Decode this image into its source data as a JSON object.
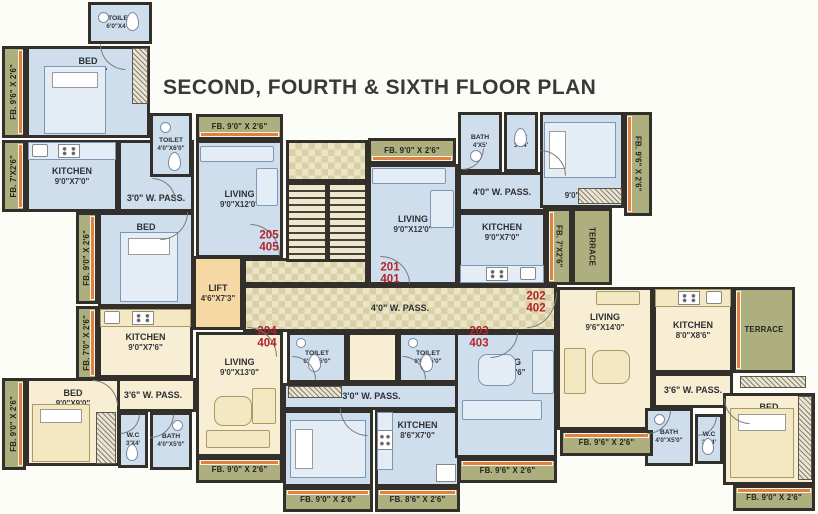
{
  "title": "SECOND, FOURTH & SIXTH FLOOR PLAN",
  "colors": {
    "wall": "#332f2a",
    "room_blue": "#cfdeed",
    "room_cream": "#f8eed4",
    "strip_olive": "#adaf7e",
    "lift_peach": "#f6d8a4",
    "corridor_light": "#ece4c6",
    "corridor_dark": "#d9d0a6",
    "unit_number_red": "#b2252b",
    "window_orange": "#e0813e",
    "title_color": "#39393b"
  },
  "title_pos": {
    "x": 163,
    "y": 76
  },
  "units": [
    {
      "lines": [
        "205",
        "405"
      ],
      "cx": 269,
      "cy": 242
    },
    {
      "lines": [
        "201",
        "401"
      ],
      "cx": 390,
      "cy": 274
    },
    {
      "lines": [
        "202",
        "402"
      ],
      "cx": 536,
      "cy": 303
    },
    {
      "lines": [
        "203",
        "403"
      ],
      "cx": 479,
      "cy": 338
    },
    {
      "lines": [
        "204",
        "404"
      ],
      "cx": 267,
      "cy": 338
    }
  ],
  "rooms": [
    {
      "label": "TOILET",
      "dims": "6'0\"X4'0\"",
      "x": 88,
      "y": 2,
      "w": 64,
      "h": 42,
      "fill": "blue",
      "small": true
    },
    {
      "label": "FB. 9'6\" X 2'6\"",
      "x": 2,
      "y": 46,
      "w": 24,
      "h": 92,
      "fill": "olive",
      "vert": "up",
      "edge": "right"
    },
    {
      "label": "BED",
      "dims": "12'6\"X9'6\"",
      "x": 26,
      "y": 46,
      "w": 124,
      "h": 92,
      "fill": "blue",
      "align": "top"
    },
    {
      "label": "FB. 7'X2'6\"",
      "x": 2,
      "y": 140,
      "w": 24,
      "h": 72,
      "fill": "olive",
      "vert": "up",
      "edge": "right"
    },
    {
      "label": "KITCHEN",
      "dims": "9'0\"X7'0\"",
      "x": 26,
      "y": 140,
      "w": 92,
      "h": 72,
      "fill": "blue"
    },
    {
      "label": "3'0\" W. PASS.",
      "x": 118,
      "y": 140,
      "w": 76,
      "h": 72,
      "fill": "blue",
      "align": "bottom"
    },
    {
      "label": "TOILET",
      "dims": "4'0\"X6'0\"",
      "x": 150,
      "y": 113,
      "w": 42,
      "h": 64,
      "fill": "blue",
      "small": true
    },
    {
      "label": "FB. 9'0\" X 2'6\"",
      "x": 196,
      "y": 114,
      "w": 87,
      "h": 26,
      "fill": "olive",
      "edge": "bottom"
    },
    {
      "label": "LIVING",
      "dims": "9'0\"X12'0\"",
      "x": 196,
      "y": 140,
      "w": 87,
      "h": 118,
      "fill": "blue"
    },
    {
      "label": "BED",
      "dims": "9'0\"X9'0\"",
      "x": 98,
      "y": 212,
      "w": 96,
      "h": 95,
      "fill": "blue",
      "align": "top"
    },
    {
      "label": "FB. 9'0\" X 2'6\"",
      "x": 76,
      "y": 212,
      "w": 22,
      "h": 92,
      "fill": "olive",
      "vert": "up",
      "edge": "right"
    },
    {
      "label": "FB. 7'0\" X 2'6\"",
      "x": 76,
      "y": 306,
      "w": 22,
      "h": 74,
      "fill": "olive",
      "vert": "up",
      "edge": "right"
    },
    {
      "label": "LIFT",
      "dims": "4'6\"X7'3\"",
      "x": 193,
      "y": 256,
      "w": 50,
      "h": 74,
      "fill": "peach"
    },
    {
      "label": "KITCHEN",
      "dims": "9'0\"X7'6\"",
      "x": 98,
      "y": 307,
      "w": 95,
      "h": 71,
      "fill": "cream"
    },
    {
      "label": "LIVING",
      "dims": "9'0\"X13'0\"",
      "x": 196,
      "y": 332,
      "w": 87,
      "h": 125,
      "fill": "cream",
      "align": "top2"
    },
    {
      "label": "3'6\" W. PASS.",
      "x": 110,
      "y": 378,
      "w": 86,
      "h": 34,
      "fill": "cream"
    },
    {
      "label": "BED",
      "dims": "9'0\"X9'0\"",
      "x": 26,
      "y": 378,
      "w": 94,
      "h": 88,
      "fill": "cream",
      "align": "top"
    },
    {
      "label": "FB. 9'0\" X 2'6\"",
      "x": 2,
      "y": 378,
      "w": 24,
      "h": 92,
      "fill": "olive",
      "vert": "up",
      "edge": "right"
    },
    {
      "label": "W.C",
      "dims": "3'X4'",
      "x": 118,
      "y": 412,
      "w": 30,
      "h": 56,
      "fill": "blue",
      "small": true
    },
    {
      "label": "BATH",
      "dims": "4'0\"X5'0\"",
      "x": 150,
      "y": 412,
      "w": 42,
      "h": 58,
      "fill": "blue",
      "small": true
    },
    {
      "label": "FB. 9'0\" X 2'6\"",
      "x": 196,
      "y": 457,
      "w": 87,
      "h": 26,
      "fill": "olive",
      "edge": "top"
    },
    {
      "label": "TOILET",
      "dims": "6'0\"X5'0\"",
      "x": 287,
      "y": 332,
      "w": 60,
      "h": 51,
      "fill": "blue",
      "small": true
    },
    {
      "label": "",
      "x": 347,
      "y": 332,
      "w": 51,
      "h": 51,
      "fill": "cream"
    },
    {
      "label": "TOILET",
      "dims": "6'0\"X5'0\"",
      "x": 398,
      "y": 332,
      "w": 60,
      "h": 51,
      "fill": "blue",
      "small": true
    },
    {
      "label": "3'0\" W. PASS.",
      "x": 283,
      "y": 383,
      "w": 177,
      "h": 27,
      "fill": "blue",
      "align": "bottom"
    },
    {
      "label": "BED",
      "dims": "9'0\"X10'6\"",
      "x": 283,
      "y": 410,
      "w": 90,
      "h": 77,
      "fill": "blue",
      "align": "split"
    },
    {
      "label": "KITCHEN",
      "dims": "8'6\"X7'0\"",
      "x": 375,
      "y": 410,
      "w": 85,
      "h": 77,
      "fill": "blue",
      "align": "top"
    },
    {
      "label": "FB. 9'0\" X 2'6\"",
      "x": 283,
      "y": 487,
      "w": 90,
      "h": 25,
      "fill": "olive",
      "edge": "top"
    },
    {
      "label": "FB. 8'6\" X 2'6\"",
      "x": 375,
      "y": 487,
      "w": 85,
      "h": 25,
      "fill": "olive",
      "edge": "top"
    },
    {
      "label": "LIVING",
      "dims": "9'6\"X12'6\"",
      "x": 455,
      "y": 332,
      "w": 102,
      "h": 126,
      "fill": "blue",
      "align": "top2"
    },
    {
      "label": "FB. 9'6\" X 2'6\"",
      "x": 458,
      "y": 458,
      "w": 99,
      "h": 25,
      "fill": "olive",
      "edge": "top"
    },
    {
      "label": "FB. 9'0\" X 2'6\"",
      "x": 368,
      "y": 138,
      "w": 88,
      "h": 26,
      "fill": "olive",
      "edge": "bottom"
    },
    {
      "label": "LIVING",
      "dims": "9'0\"X12'0\"",
      "x": 368,
      "y": 164,
      "w": 90,
      "h": 121,
      "fill": "blue"
    },
    {
      "label": "BATH",
      "dims": "4'X5'",
      "x": 458,
      "y": 112,
      "w": 44,
      "h": 60,
      "fill": "blue",
      "small": true
    },
    {
      "label": "W.C",
      "dims": "3'X4'",
      "x": 504,
      "y": 112,
      "w": 34,
      "h": 60,
      "fill": "blue",
      "small": true
    },
    {
      "label": "4'0\" W. PASS.",
      "x": 458,
      "y": 172,
      "w": 88,
      "h": 40,
      "fill": "blue"
    },
    {
      "label": "KITCHEN",
      "dims": "9'0\"X7'0\"",
      "x": 458,
      "y": 212,
      "w": 88,
      "h": 73,
      "fill": "blue",
      "align": "top"
    },
    {
      "label": "BED",
      "dims": "9'0\"X9'6\"",
      "x": 540,
      "y": 112,
      "w": 84,
      "h": 96,
      "fill": "blue",
      "align": "split"
    },
    {
      "label": "FB. 9'6\" X 2'6\"",
      "x": 624,
      "y": 112,
      "w": 28,
      "h": 104,
      "fill": "olive",
      "vert": "down",
      "edge": "left"
    },
    {
      "label": "FB. 7'X2'6\"",
      "x": 546,
      "y": 208,
      "w": 26,
      "h": 77,
      "fill": "olive",
      "vert": "down",
      "edge": "left"
    },
    {
      "label": "TERRACE",
      "x": 572,
      "y": 208,
      "w": 40,
      "h": 77,
      "fill": "olive",
      "vert": "down"
    },
    {
      "label": "LIVING",
      "dims": "9'6\"X14'0\"",
      "x": 557,
      "y": 287,
      "w": 96,
      "h": 143,
      "fill": "cream",
      "align": "top2"
    },
    {
      "label": "KITCHEN",
      "dims": "8'0\"X8'6\"",
      "x": 653,
      "y": 287,
      "w": 80,
      "h": 86,
      "fill": "cream"
    },
    {
      "label": "TERRACE",
      "x": 733,
      "y": 287,
      "w": 62,
      "h": 86,
      "fill": "olive",
      "edge": "left"
    },
    {
      "label": "3'6\" W. PASS.",
      "x": 653,
      "y": 373,
      "w": 80,
      "h": 35,
      "fill": "cream"
    },
    {
      "label": "BATH",
      "dims": "4'0\"X5'0\"",
      "x": 645,
      "y": 408,
      "w": 48,
      "h": 58,
      "fill": "blue",
      "small": true
    },
    {
      "label": "W.C",
      "dims": "3'X4'",
      "x": 695,
      "y": 414,
      "w": 28,
      "h": 50,
      "fill": "blue",
      "small": true
    },
    {
      "label": "BED",
      "dims": "9'0\"X11'6\"",
      "x": 723,
      "y": 393,
      "w": 92,
      "h": 92,
      "fill": "cream",
      "align": "split"
    },
    {
      "label": "FB. 9'0\" X 2'6\"",
      "x": 733,
      "y": 485,
      "w": 82,
      "h": 26,
      "fill": "olive",
      "edge": "top"
    },
    {
      "label": "FB. 9'6\" X 2'6\"",
      "x": 560,
      "y": 430,
      "w": 93,
      "h": 26,
      "fill": "olive",
      "edge": "top"
    },
    {
      "label": "4'0\" W. PASS.",
      "x": 243,
      "y": 285,
      "w": 314,
      "h": 47,
      "fill": "checker"
    },
    {
      "label": "",
      "x": 243,
      "y": 258,
      "w": 125,
      "h": 27,
      "fill": "checker"
    },
    {
      "label": "",
      "x": 286,
      "y": 140,
      "w": 82,
      "h": 42,
      "fill": "checker"
    },
    {
      "label": "",
      "x": 286,
      "y": 182,
      "w": 82,
      "h": 80,
      "fill": "stairs"
    }
  ],
  "furniture": [
    {
      "type": "bed",
      "x": 44,
      "y": 66,
      "w": 62,
      "h": 68,
      "tone": "b",
      "pillow": "top"
    },
    {
      "type": "bed",
      "x": 120,
      "y": 232,
      "w": 58,
      "h": 70,
      "tone": "b",
      "pillow": "top"
    },
    {
      "type": "bed",
      "x": 544,
      "y": 122,
      "w": 72,
      "h": 56,
      "tone": "b",
      "pillow": "left"
    },
    {
      "type": "bed",
      "x": 730,
      "y": 408,
      "w": 64,
      "h": 70,
      "tone": "c",
      "pillow": "top"
    },
    {
      "type": "bed",
      "x": 290,
      "y": 420,
      "w": 76,
      "h": 58,
      "tone": "b",
      "pillow": "left"
    },
    {
      "type": "bed",
      "x": 32,
      "y": 404,
      "w": 58,
      "h": 58,
      "tone": "c",
      "pillow": "top"
    },
    {
      "type": "sofa",
      "x": 200,
      "y": 146,
      "w": 74,
      "h": 16,
      "tone": "b"
    },
    {
      "type": "sofa",
      "x": 256,
      "y": 168,
      "w": 22,
      "h": 38,
      "tone": "b"
    },
    {
      "type": "sofa",
      "x": 372,
      "y": 168,
      "w": 74,
      "h": 16,
      "tone": "b"
    },
    {
      "type": "sofa",
      "x": 430,
      "y": 190,
      "w": 24,
      "h": 38,
      "tone": "b"
    },
    {
      "type": "sofa",
      "x": 462,
      "y": 400,
      "w": 80,
      "h": 20,
      "tone": "b"
    },
    {
      "type": "sofa",
      "x": 532,
      "y": 350,
      "w": 22,
      "h": 44,
      "tone": "b"
    },
    {
      "type": "table",
      "x": 478,
      "y": 354,
      "w": 38,
      "h": 32,
      "tone": "b"
    },
    {
      "type": "sofa",
      "x": 596,
      "y": 291,
      "w": 44,
      "h": 14,
      "tone": "c"
    },
    {
      "type": "sofa",
      "x": 564,
      "y": 348,
      "w": 22,
      "h": 46,
      "tone": "c"
    },
    {
      "type": "table",
      "x": 592,
      "y": 350,
      "w": 38,
      "h": 34,
      "tone": "c"
    },
    {
      "type": "table",
      "x": 214,
      "y": 396,
      "w": 38,
      "h": 30,
      "tone": "c"
    },
    {
      "type": "sofa",
      "x": 206,
      "y": 430,
      "w": 64,
      "h": 18,
      "tone": "c"
    },
    {
      "type": "sofa",
      "x": 252,
      "y": 388,
      "w": 24,
      "h": 36,
      "tone": "c"
    },
    {
      "type": "plat",
      "x": 28,
      "y": 142,
      "w": 88,
      "h": 18,
      "tone": "b"
    },
    {
      "type": "stove",
      "x": 58,
      "y": 144,
      "w": 22,
      "h": 14
    },
    {
      "type": "sink",
      "x": 32,
      "y": 144,
      "w": 16,
      "h": 13
    },
    {
      "type": "plat",
      "x": 100,
      "y": 309,
      "w": 91,
      "h": 18,
      "tone": "c"
    },
    {
      "type": "stove",
      "x": 132,
      "y": 311,
      "w": 22,
      "h": 14
    },
    {
      "type": "sink",
      "x": 104,
      "y": 311,
      "w": 16,
      "h": 13
    },
    {
      "type": "plat",
      "x": 460,
      "y": 265,
      "w": 84,
      "h": 18,
      "tone": "b"
    },
    {
      "type": "stove",
      "x": 486,
      "y": 267,
      "w": 22,
      "h": 14
    },
    {
      "type": "sink",
      "x": 520,
      "y": 267,
      "w": 16,
      "h": 13
    },
    {
      "type": "plat",
      "x": 655,
      "y": 289,
      "w": 76,
      "h": 18,
      "tone": "c"
    },
    {
      "type": "stove",
      "x": 678,
      "y": 291,
      "w": 22,
      "h": 14
    },
    {
      "type": "sink",
      "x": 706,
      "y": 291,
      "w": 16,
      "h": 13
    },
    {
      "type": "plat",
      "x": 377,
      "y": 412,
      "w": 16,
      "h": 58,
      "tone": "b"
    },
    {
      "type": "stove",
      "x": 377,
      "y": 430,
      "w": 16,
      "h": 20
    },
    {
      "type": "fridge",
      "x": 436,
      "y": 464,
      "w": 20,
      "h": 18
    },
    {
      "type": "wc",
      "x": 126,
      "y": 12,
      "w": 13,
      "h": 19
    },
    {
      "type": "basin",
      "x": 98,
      "y": 12,
      "w": 11,
      "h": 11
    },
    {
      "type": "wc",
      "x": 168,
      "y": 152,
      "w": 13,
      "h": 19
    },
    {
      "type": "basin",
      "x": 160,
      "y": 122,
      "w": 11,
      "h": 11
    },
    {
      "type": "wc",
      "x": 514,
      "y": 128,
      "w": 13,
      "h": 19
    },
    {
      "type": "basin",
      "x": 470,
      "y": 150,
      "w": 12,
      "h": 12
    },
    {
      "type": "wc",
      "x": 308,
      "y": 354,
      "w": 13,
      "h": 18
    },
    {
      "type": "basin",
      "x": 296,
      "y": 338,
      "w": 10,
      "h": 10
    },
    {
      "type": "wc",
      "x": 420,
      "y": 354,
      "w": 13,
      "h": 18
    },
    {
      "type": "basin",
      "x": 408,
      "y": 338,
      "w": 10,
      "h": 10
    },
    {
      "type": "wc",
      "x": 126,
      "y": 444,
      "w": 12,
      "h": 17
    },
    {
      "type": "basin",
      "x": 172,
      "y": 420,
      "w": 11,
      "h": 11
    },
    {
      "type": "wc",
      "x": 702,
      "y": 438,
      "w": 12,
      "h": 17
    },
    {
      "type": "basin",
      "x": 654,
      "y": 414,
      "w": 11,
      "h": 11
    },
    {
      "type": "hatch",
      "x": 132,
      "y": 48,
      "w": 16,
      "h": 56
    },
    {
      "type": "hatch",
      "x": 578,
      "y": 188,
      "w": 44,
      "h": 16
    },
    {
      "type": "hatch",
      "x": 740,
      "y": 376,
      "w": 66,
      "h": 12
    },
    {
      "type": "hatch",
      "x": 798,
      "y": 396,
      "w": 14,
      "h": 84
    },
    {
      "type": "hatch",
      "x": 288,
      "y": 386,
      "w": 54,
      "h": 12
    },
    {
      "type": "hatch",
      "x": 96,
      "y": 412,
      "w": 20,
      "h": 52
    }
  ],
  "doors": [
    {
      "x": 250,
      "y": 224,
      "w": 30,
      "h": 32,
      "quad": "tr"
    },
    {
      "x": 380,
      "y": 256,
      "w": 30,
      "h": 28,
      "quad": "tr"
    },
    {
      "x": 527,
      "y": 292,
      "w": 30,
      "h": 36,
      "quad": "br"
    },
    {
      "x": 490,
      "y": 332,
      "w": 28,
      "h": 26,
      "quad": "br"
    },
    {
      "x": 247,
      "y": 327,
      "w": 30,
      "h": 30,
      "quad": "tr"
    },
    {
      "x": 100,
      "y": 44,
      "w": 26,
      "h": 26,
      "quad": "bl"
    },
    {
      "x": 152,
      "y": 178,
      "w": 24,
      "h": 24,
      "quad": "tr"
    },
    {
      "x": 462,
      "y": 148,
      "w": 22,
      "h": 22,
      "quad": "br"
    },
    {
      "x": 540,
      "y": 150,
      "w": 26,
      "h": 26,
      "quad": "tr"
    },
    {
      "x": 160,
      "y": 212,
      "w": 28,
      "h": 28,
      "quad": "br"
    },
    {
      "x": 292,
      "y": 356,
      "w": 24,
      "h": 24,
      "quad": "tr"
    },
    {
      "x": 402,
      "y": 356,
      "w": 24,
      "h": 24,
      "quad": "tr"
    },
    {
      "x": 340,
      "y": 408,
      "w": 28,
      "h": 28,
      "quad": "bl"
    },
    {
      "x": 92,
      "y": 380,
      "w": 26,
      "h": 26,
      "quad": "tr"
    },
    {
      "x": 150,
      "y": 414,
      "w": 24,
      "h": 24,
      "quad": "br"
    },
    {
      "x": 120,
      "y": 414,
      "w": 20,
      "h": 20,
      "quad": "br"
    },
    {
      "x": 647,
      "y": 410,
      "w": 24,
      "h": 24,
      "quad": "br"
    },
    {
      "x": 697,
      "y": 416,
      "w": 20,
      "h": 20,
      "quad": "br"
    },
    {
      "x": 724,
      "y": 398,
      "w": 26,
      "h": 26,
      "quad": "bl"
    }
  ]
}
